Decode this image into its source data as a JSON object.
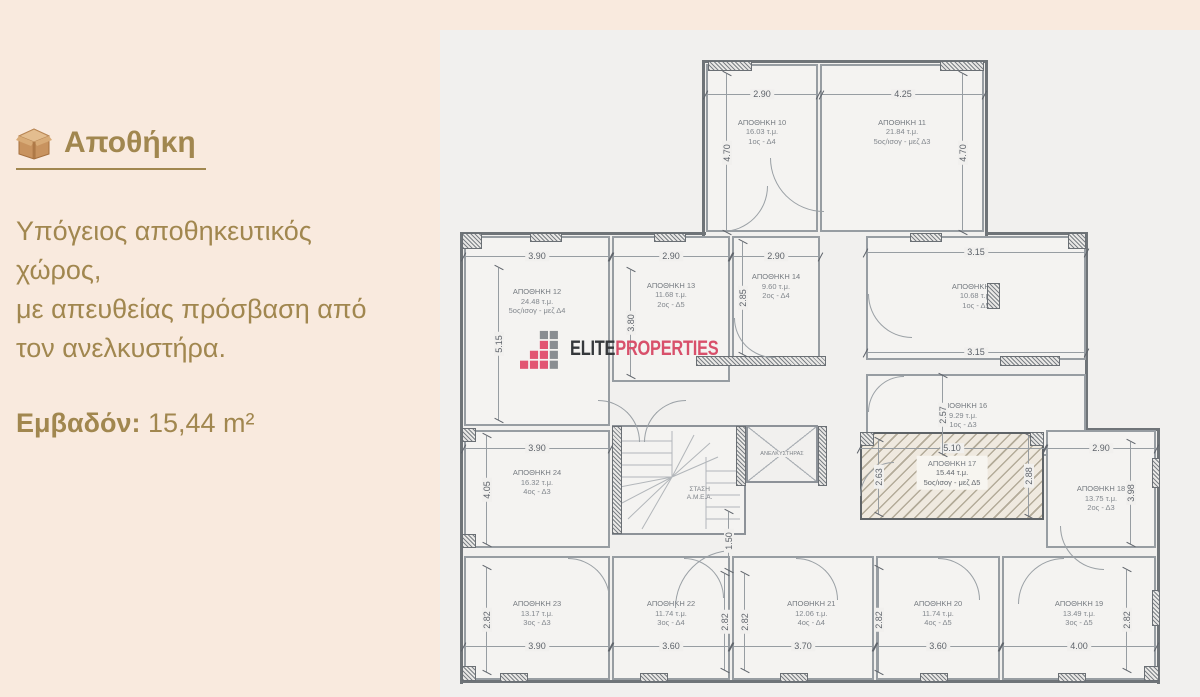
{
  "sidebar": {
    "title": "Αποθήκη",
    "description_lines": [
      "Υπόγειος αποθηκευτικός",
      "χώρος,",
      "με απευθείας πρόσβαση από",
      "τον ανελκυστήρα."
    ],
    "area_label": "Εμβαδόν:",
    "area_value": " 15,44 m²"
  },
  "brand": {
    "name_primary": "ELITE",
    "name_secondary": "PROPERTIES"
  },
  "plan": {
    "stairs_label_1": "ΣΤΑΣΗ",
    "stairs_label_2": "Α.Μ.Ε.Α.",
    "elevator_label": "ΑΝΕΛΚΥΣΤΗΡΑΣ",
    "rooms": [
      {
        "name": "ΑΠΟΘΗΚΗ 10",
        "area": "16.03 τ.μ.",
        "floor": "1ος - Δ4"
      },
      {
        "name": "ΑΠΟΘΗΚΗ 11",
        "area": "21.84 τ.μ.",
        "floor": "5ος/ισογ - μεζ Δ3"
      },
      {
        "name": "ΑΠΟΘΗΚΗ 12",
        "area": "24.48 τ.μ.",
        "floor": "5ος/ισογ - μεζ Δ4"
      },
      {
        "name": "ΑΠΟΘΗΚΗ 13",
        "area": "11.68 τ.μ.",
        "floor": "2ος - Δ5"
      },
      {
        "name": "ΑΠΟΘΗΚΗ 14",
        "area": "9.60 τ.μ.",
        "floor": "2ος - Δ4"
      },
      {
        "name": "ΑΠΟΘΗΚΗ 15",
        "area": "10.68 τ.μ.",
        "floor": "1ος - Δ5"
      },
      {
        "name": "ΑΠΟΘΗΚΗ 16",
        "area": "9.29 τ.μ.",
        "floor": "1ος - Δ3"
      },
      {
        "name": "ΑΠΟΘΗΚΗ 17",
        "area": "15.44 τ.μ.",
        "floor": "5ος/ισογ - μεζ Δ5",
        "highlighted": true
      },
      {
        "name": "ΑΠΟΘΗΚΗ 18",
        "area": "13.75 τ.μ.",
        "floor": "2ος - Δ3"
      },
      {
        "name": "ΑΠΟΘΗΚΗ 19",
        "area": "13.49 τ.μ.",
        "floor": "3ος - Δ5"
      },
      {
        "name": "ΑΠΟΘΗΚΗ 20",
        "area": "11.74 τ.μ.",
        "floor": "4ος - Δ5"
      },
      {
        "name": "ΑΠΟΘΗΚΗ 21",
        "area": "12.06 τ.μ.",
        "floor": "4ος - Δ4"
      },
      {
        "name": "ΑΠΟΘΗΚΗ 22",
        "area": "11.74 τ.μ.",
        "floor": "3ος - Δ4"
      },
      {
        "name": "ΑΠΟΘΗΚΗ 23",
        "area": "13.17 τ.μ.",
        "floor": "3ος - Δ3"
      },
      {
        "name": "ΑΠΟΘΗΚΗ 24",
        "area": "16.32 τ.μ.",
        "floor": "4ος - Δ3"
      }
    ],
    "dims": {
      "r10_w": "2.90",
      "r11_w": "4.25",
      "top_h_l": "4.70",
      "top_h_r": "4.70",
      "r12_w": "3.90",
      "r13_w": "2.90",
      "r14_w": "2.90",
      "r15_w": "3.15",
      "r16_w": "3.15",
      "r12_h": "5.15",
      "r13_h": "3.80",
      "r14_h": "2.85",
      "r16_h": "2.57",
      "r24_w": "3.90",
      "r24_h": "4.05",
      "r17_w": "5.10",
      "r17_h_l": "2.63",
      "r17_h_r": "2.88",
      "r18_w": "2.90",
      "r18_h": "3.98",
      "stair_d": "1.50",
      "b_h1": "2.82",
      "b_h2": "2.82",
      "b_h3": "2.82",
      "b_h4": "2.82",
      "b_h5": "2.82",
      "r23_w": "3.90",
      "r22_w": "3.60",
      "r21_w": "3.70",
      "r20_w": "3.60",
      "r19_w": "4.00"
    }
  },
  "colors": {
    "page_bg": "#f9eade",
    "plan_bg": "#f1f0ee",
    "accent_text": "#a1874f",
    "brand_pink": "#d8506b",
    "brand_dark": "#35383b"
  }
}
